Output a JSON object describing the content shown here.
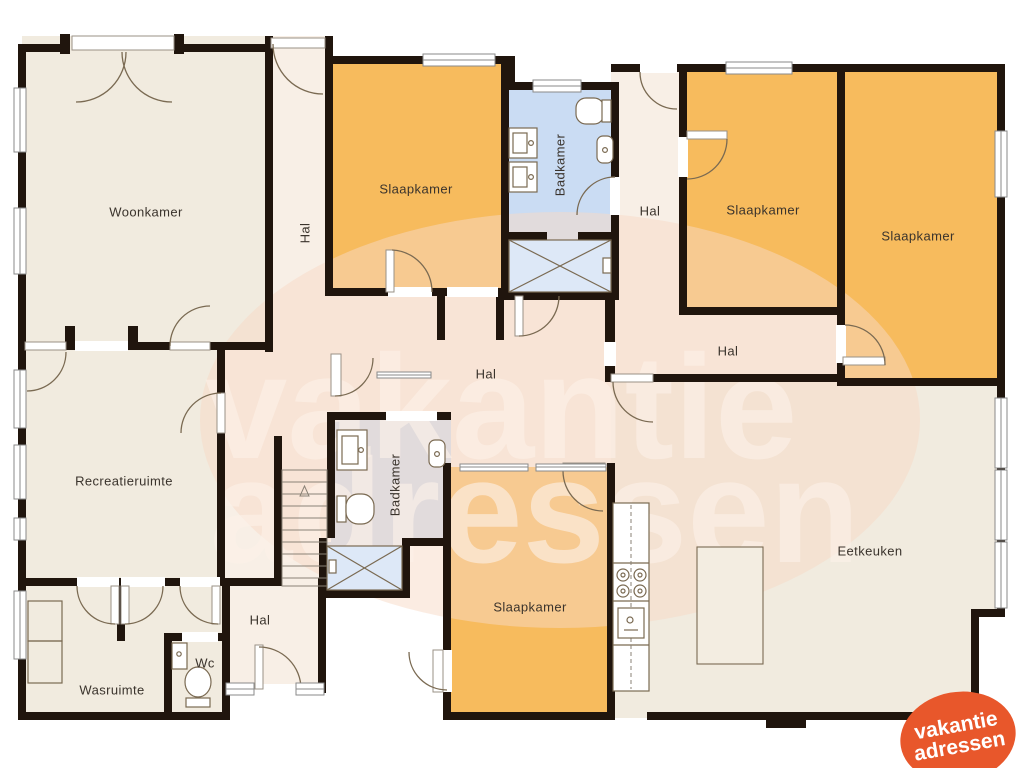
{
  "floorplan": {
    "rooms": [
      {
        "id": "woonkamer",
        "label": "Woonkamer"
      },
      {
        "id": "hal-corridor",
        "label": "Hal"
      },
      {
        "id": "slaapkamer-1",
        "label": "Slaapkamer"
      },
      {
        "id": "badkamer-1",
        "label": "Badkamer"
      },
      {
        "id": "hal-topright",
        "label": "Hal"
      },
      {
        "id": "slaapkamer-2",
        "label": "Slaapkamer"
      },
      {
        "id": "slaapkamer-3",
        "label": "Slaapkamer"
      },
      {
        "id": "hal-midright",
        "label": "Hal"
      },
      {
        "id": "hal-central",
        "label": "Hal"
      },
      {
        "id": "recreatieruimte",
        "label": "Recreatieruimte"
      },
      {
        "id": "badkamer-2",
        "label": "Badkamer"
      },
      {
        "id": "slaapkamer-4",
        "label": "Slaapkamer"
      },
      {
        "id": "eetkeuken",
        "label": "Eetkeuken"
      },
      {
        "id": "hal-bottom",
        "label": "Hal"
      },
      {
        "id": "wasruimte",
        "label": "Wasruimte"
      },
      {
        "id": "wc",
        "label": "Wc"
      }
    ],
    "watermark": {
      "line1": "vakantie",
      "line2": "adressen"
    },
    "logo": {
      "line1": "vakantie",
      "line2": "adressen"
    },
    "colors": {
      "wall": "#20150d",
      "cream": "#f1ebdf",
      "hall": "#f8efe6",
      "bedroom": "#f7bb5d",
      "bathroom": "#cadcf3",
      "watermark": "#f7d9c6",
      "watermarkText": "#fdf2e9",
      "logo": "#e8572b",
      "line": "#7a6a52"
    }
  }
}
